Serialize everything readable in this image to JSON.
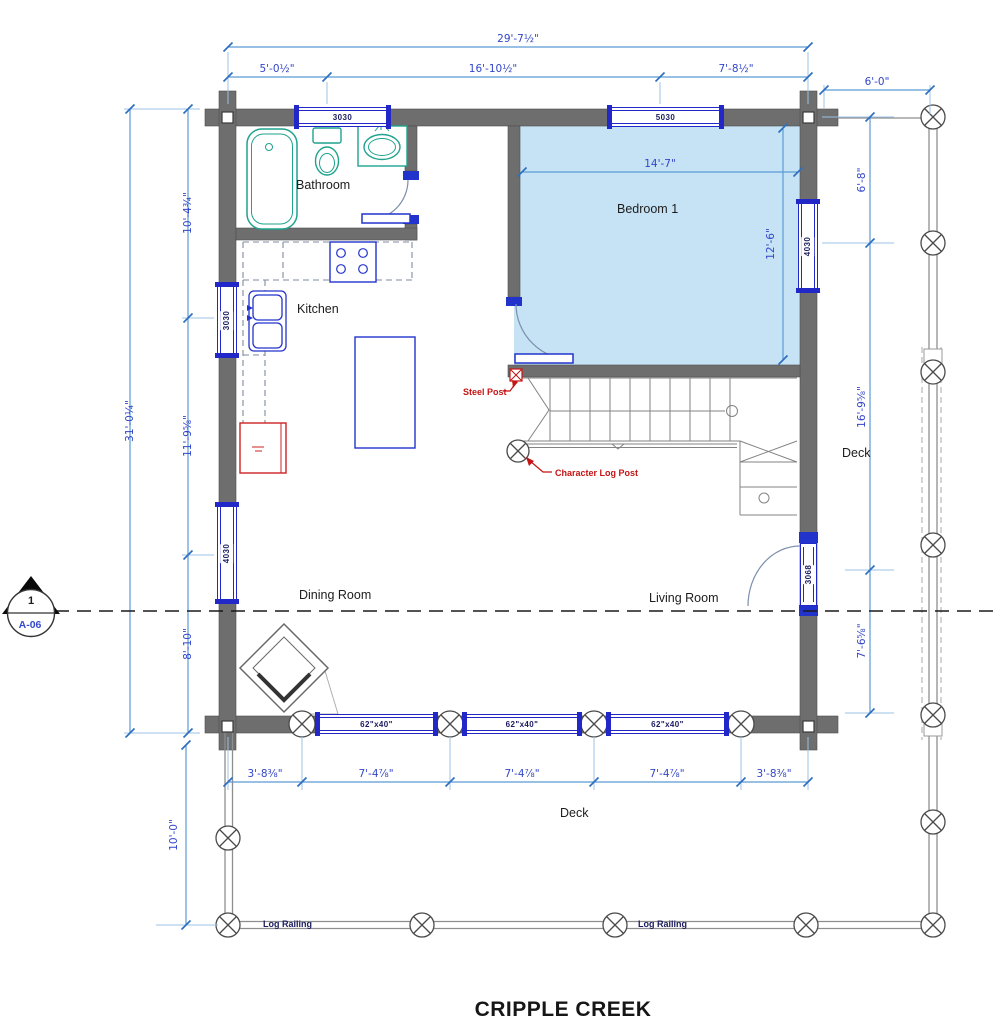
{
  "title": "CRIPPLE CREEK",
  "section_marker": {
    "detail_number": "1",
    "sheet_number": "A-06"
  },
  "rooms": {
    "bathroom": "Bathroom",
    "kitchen": "Kitchen",
    "bedroom1": "Bedroom 1",
    "dining": "Dining Room",
    "living": "Living Room",
    "deck_side": "Deck",
    "deck_front": "Deck"
  },
  "annotations": {
    "steel_post": "Steel Post",
    "character_log_post": "Character Log Post",
    "log_railing_1": "Log Railing",
    "log_railing_2": "Log Railing"
  },
  "openings": {
    "window_top_left": "3030",
    "window_top_right": "5030",
    "window_bedroom_right": "4030",
    "window_kitchen_left": "3030",
    "window_dining_left": "4030",
    "window_deck_1": "62\"x40\"",
    "window_deck_2": "62\"x40\"",
    "window_deck_3": "62\"x40\"",
    "door_living": "3068"
  },
  "dimensions": {
    "top_overall": "29'-7½\"",
    "top_seg_1": "5'-0½\"",
    "top_seg_2": "16'-10½\"",
    "top_seg_3": "7'-8½\"",
    "deck_width": "6'-0\"",
    "left_overall": "31'-0¼\"",
    "left_seg_1": "10'-4¾\"",
    "left_seg_2": "11'-9⅝\"",
    "left_seg_3": "8'-10\"",
    "right_seg_1": "6'-8\"",
    "right_seg_2": "16'-9⅝\"",
    "right_seg_3": "7'-6⅝\"",
    "bedroom_width": "14'-7\"",
    "bedroom_depth": "12'-6\"",
    "bottom_seg_1": "3'-8⅜\"",
    "bottom_seg_2": "7'-4⅞\"",
    "bottom_seg_3": "7'-4⅞\"",
    "bottom_seg_4": "7'-4⅞\"",
    "bottom_seg_5": "3'-8⅜\"",
    "deck_depth": "10'-0\""
  },
  "colors": {
    "wall": "#6e6e6e",
    "window_blue": "#2228c8",
    "dimension_text": "#3246c8",
    "dimension_line": "#5b9bd5",
    "fixture_teal": "#1fa28e",
    "accent_red": "#c41414",
    "bedroom_fill": "#c5e3f4",
    "railing_gray": "#8e8e8e"
  }
}
